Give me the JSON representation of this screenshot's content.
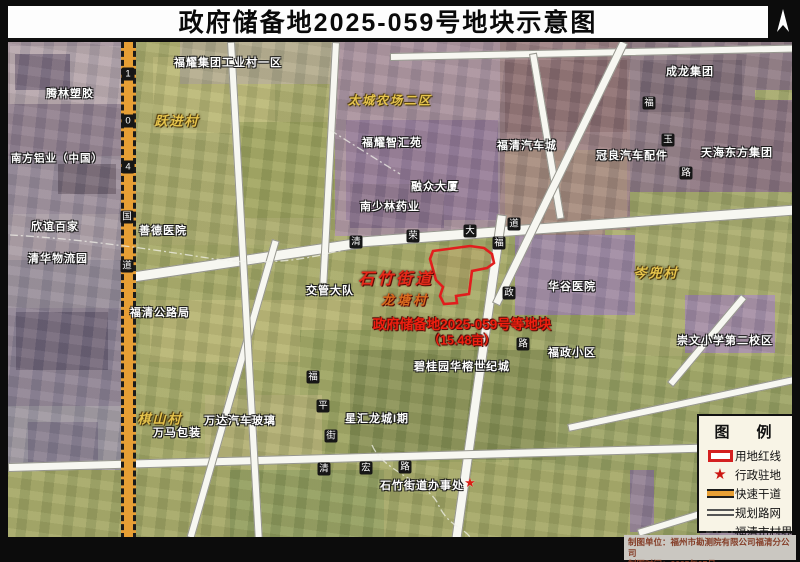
{
  "title": "政府储备地2025-059号地块示意图",
  "map": {
    "place_labels": [
      {
        "text": "腾林塑胶"
      },
      {
        "text": "南方铝业（中国）"
      },
      {
        "text": "欣谊百家"
      },
      {
        "text": "清华物流园"
      },
      {
        "text": "善德医院"
      },
      {
        "text": "福清公路局"
      },
      {
        "text": "万马包装"
      },
      {
        "text": "万达汽车玻璃"
      },
      {
        "text": "星汇龙城I期"
      },
      {
        "text": "碧桂园华榕世纪城"
      },
      {
        "text": "石竹街道办事处"
      },
      {
        "text": "交管大队"
      },
      {
        "text": "福耀集团工业村一区"
      },
      {
        "text": "福耀智汇苑"
      },
      {
        "text": "融众大厦"
      },
      {
        "text": "南少林药业"
      },
      {
        "text": "福清汽车城"
      },
      {
        "text": "成龙集团"
      },
      {
        "text": "冠良汽车配件"
      },
      {
        "text": "天海东方集团"
      },
      {
        "text": "华谷医院"
      },
      {
        "text": "福政小区"
      },
      {
        "text": "崇文小学第二校区"
      }
    ],
    "village_labels": [
      {
        "text": "跃进村"
      },
      {
        "text": "太城农场二区"
      },
      {
        "text": "棋山村"
      },
      {
        "text": "岑兜村"
      }
    ],
    "red_labels": {
      "street": "石竹街道",
      "village": "龙塘村",
      "parcel_line1": "政府储备地2025-059号等地块",
      "parcel_line2": "（15.48亩）"
    },
    "roads": {
      "g104": [
        "1",
        "0",
        "4",
        "国",
        "道"
      ],
      "qingrong": [
        "清",
        "荣",
        "大",
        "道"
      ],
      "fuzheng": [
        "福",
        "政",
        "路"
      ],
      "fuyu": [
        "福",
        "玉",
        "路"
      ],
      "qinghong": [
        "清",
        "宏",
        "路"
      ],
      "fuping": [
        "福",
        "平",
        "街"
      ]
    },
    "star_glyph": "★"
  },
  "legend": {
    "title": "图　例",
    "items": [
      {
        "label": "用地红线"
      },
      {
        "label": "行政驻地"
      },
      {
        "label": "快速干道"
      },
      {
        "label": "规划路网"
      },
      {
        "label": "福清市村界"
      }
    ]
  },
  "footer": {
    "line1": "制图单位：福州市勘测院有限公司福清分公司",
    "line2": "制图时间：2025年07月"
  },
  "colors": {
    "parcel_red": "#e11d1d",
    "expressway_orange": "#e79f35",
    "red_label": "#ef1f10",
    "village_gold": "#e6c44c"
  }
}
